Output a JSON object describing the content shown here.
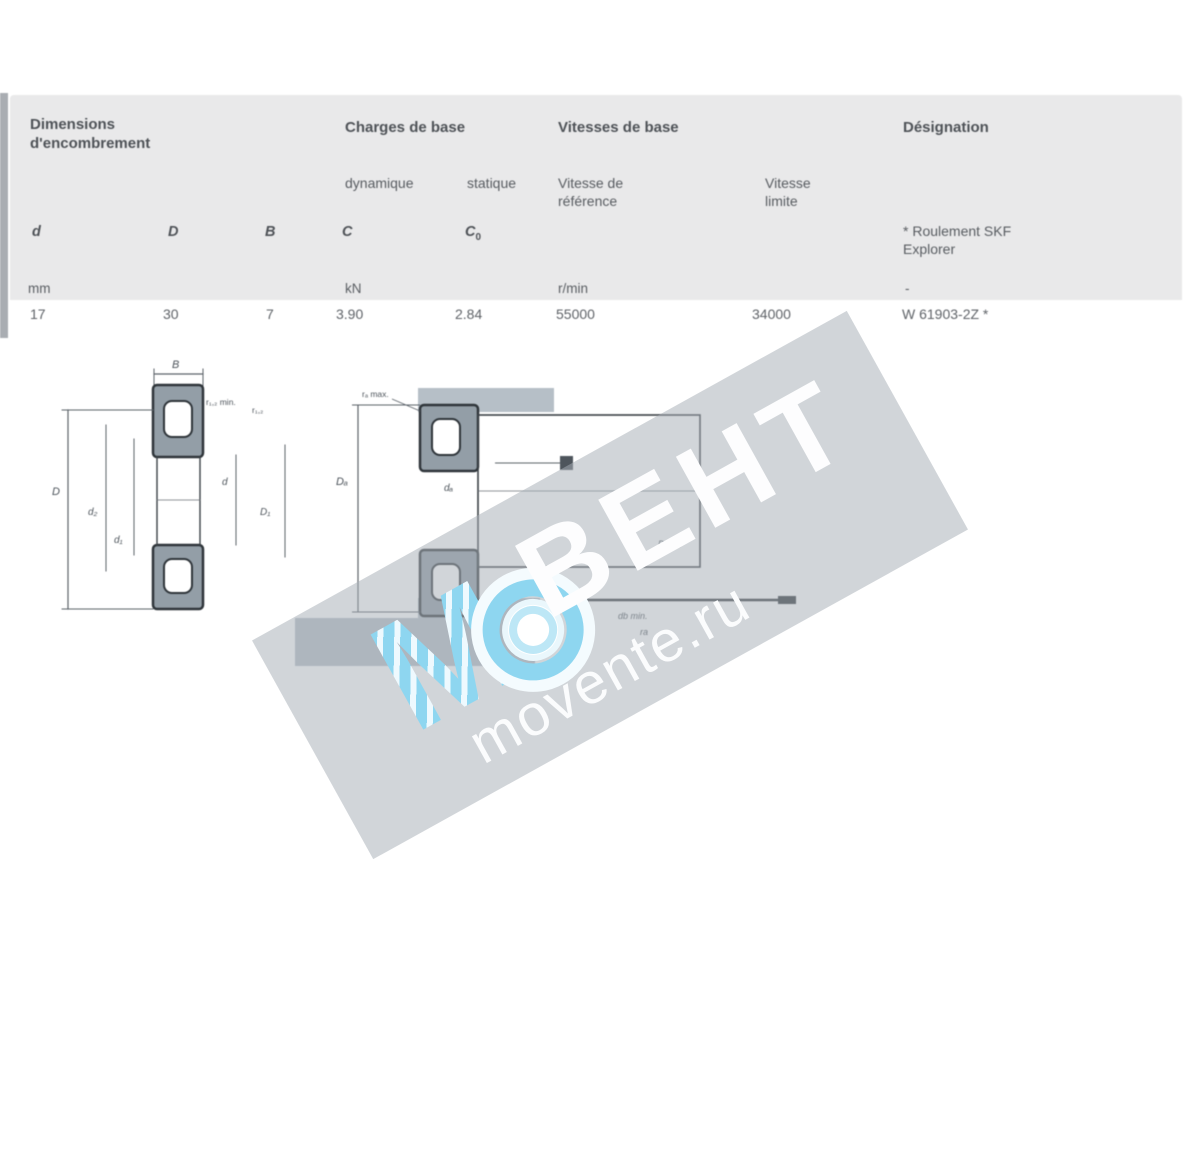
{
  "table": {
    "group_headers": {
      "dimensions_line1": "Dimensions",
      "dimensions_line2": "d'encombrement",
      "loads": "Charges de base",
      "speeds": "Vitesses de base",
      "designation": "Désignation"
    },
    "sub_headers": {
      "dynamic": "dynamique",
      "static": "statique",
      "ref_speed_line1": "Vitesse de",
      "ref_speed_line2": "référence",
      "lim_speed_line1": "Vitesse",
      "lim_speed_line2": "limite",
      "designation_note_line1": "* Roulement SKF",
      "designation_note_line2": "Explorer"
    },
    "symbols": {
      "d": "d",
      "D": "D",
      "B": "B",
      "C": "C",
      "C0_base": "C",
      "C0_sub": "0"
    },
    "units": {
      "dims": "mm",
      "loads": "kN",
      "speeds": "r/min",
      "designation": "-"
    },
    "row": {
      "d": "17",
      "D": "30",
      "B": "7",
      "C": "3.90",
      "C0": "2.84",
      "ref_speed": "55000",
      "lim_speed": "34000",
      "designation": "W 61903-2Z *"
    }
  },
  "drawing": {
    "fig1": {
      "B": "B",
      "r12": "r₁,₂ min.",
      "r12b": "r₁,₂",
      "D": "D",
      "d2": "d₂",
      "d1": "d₁",
      "d": "d",
      "D1": "D₁"
    },
    "fig2": {
      "ra": "rₐ max.",
      "Da": "Dₐ",
      "da": "dₐ",
      "right": "Da H7",
      "bottom1": "db min.",
      "bottom2": "ra"
    }
  },
  "watermark": {
    "brand": "ВЕНТ",
    "site": "movente.ru",
    "logo_letter": "М",
    "band_color": "#aab2bb",
    "logo_blue": "#8ed6f0"
  }
}
